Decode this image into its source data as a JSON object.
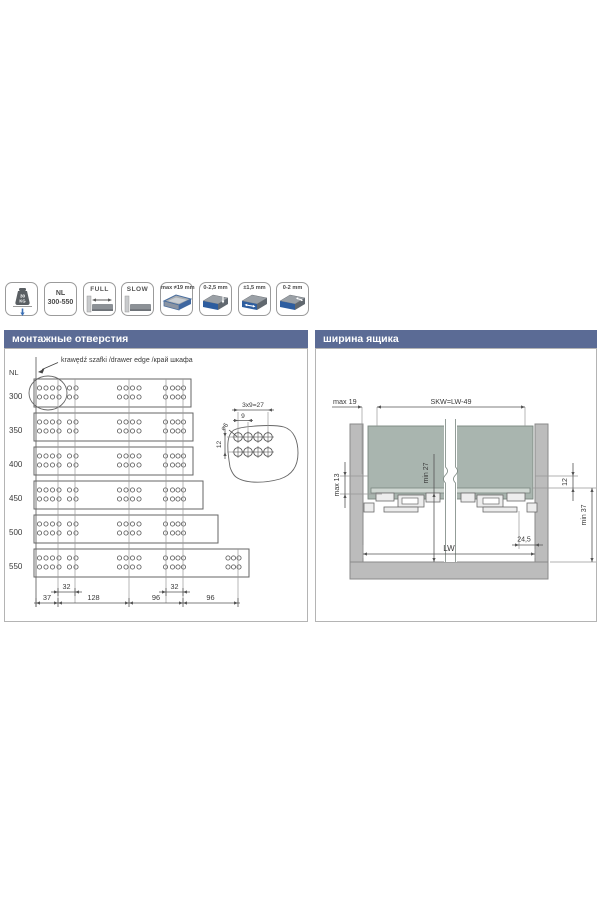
{
  "icon_bar": {
    "icons": [
      {
        "id": "load-capacity",
        "top": "30",
        "bottom": "KG"
      },
      {
        "id": "nominal-length",
        "line1": "NL",
        "line2": "300-550"
      },
      {
        "id": "full-extension",
        "label": "FULL"
      },
      {
        "id": "soft-close",
        "label": "SLOW"
      },
      {
        "id": "board-thickness",
        "label": "max ≠19 mm"
      },
      {
        "id": "height-adjustment",
        "label": "0-2,5 mm"
      },
      {
        "id": "side-adjustment",
        "label": "±1,5 mm"
      },
      {
        "id": "tilt-adjustment",
        "label": "0-2 mm"
      }
    ]
  },
  "left_panel": {
    "header": "монтажные отверстия",
    "nl_label": "NL",
    "edge_label": "krawędź szafki /drawer edge /край шкафа",
    "rows": [
      "300",
      "350",
      "400",
      "450",
      "500",
      "550"
    ],
    "chain_dims": [
      "37",
      "128",
      "96",
      "96"
    ],
    "small_dims": [
      "32",
      "32"
    ],
    "detail": {
      "span": "3x9=27",
      "pitch": "9",
      "diameter": "⌀6",
      "row_gap": "12"
    }
  },
  "right_panel": {
    "header": "ширина ящика",
    "dims": {
      "max19": "max 19",
      "skw": "SKW=LW-49",
      "max13": "max 13",
      "min27": "min 27",
      "twelve": "12",
      "min37": "min 37",
      "rear": "24,5",
      "lw": "LW"
    }
  },
  "colors": {
    "header_bg": "#5b6b95",
    "accent_blue": "#2d5d9f",
    "drawer_fill": "#a9b5af",
    "board_fill": "#cfd7d2",
    "cabinet_fill": "#bcbcbc",
    "line": "#4a4a4a",
    "arrow_blue": "#3a6fb5"
  }
}
